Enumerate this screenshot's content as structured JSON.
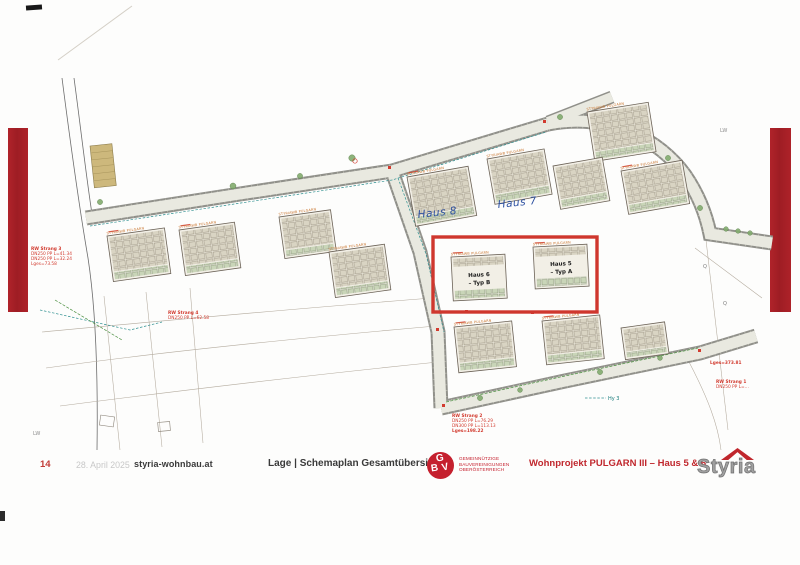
{
  "page": {
    "number": "14",
    "date": "28. April 2025",
    "site": "styria-wohnbau.at"
  },
  "footer": {
    "section_title": "Lage | Schemaplan Gesamtübersicht",
    "project_title": "Wohnprojekt  PULGARN III – Haus 5 & 6",
    "styria": "Styria",
    "gbv": {
      "g": "G",
      "b": "B",
      "v": "V",
      "line1": "GEMEINNÜTZIGE",
      "line2": "BAUVEREINIGUNGEN",
      "line3": "OBERÖSTERREICH"
    }
  },
  "plan": {
    "building_label": "STYRIAWB  PULGARN",
    "highlight": {
      "haus6_line1": "Haus 6",
      "haus6_line2": "– Typ B",
      "haus5_line1": "Haus 5",
      "haus5_line2": "– Typ A"
    },
    "handwriting": {
      "haus8": "Haus 8",
      "haus7": "Haus 7"
    },
    "annotations": {
      "rw3": [
        "RW Strang 3",
        "DN250 PP L=41.34",
        "DN250 PP L=32.24",
        "Lges=73.58"
      ],
      "rw4": [
        "RW Strang 4",
        "DN250 PP L=62.58"
      ],
      "rw2": [
        "RW Strang 2",
        "DN250 PP L=76.29",
        "DN300 PP L=113.13",
        "Lges=198.22"
      ],
      "rw1": [
        "Lges=373.81",
        "RW Strang 1",
        "DN250 PP L=…"
      ],
      "hy3": "Hy 3",
      "lw": "LW",
      "q": "Q"
    },
    "colors": {
      "highlight_red": "#cf372e",
      "bar_red": "#b0232a",
      "annotation_red": "#d23b2f",
      "teal": "#2f9090",
      "handwriting_blue": "#2b4fa0",
      "building_orange": "#c8722a"
    }
  }
}
